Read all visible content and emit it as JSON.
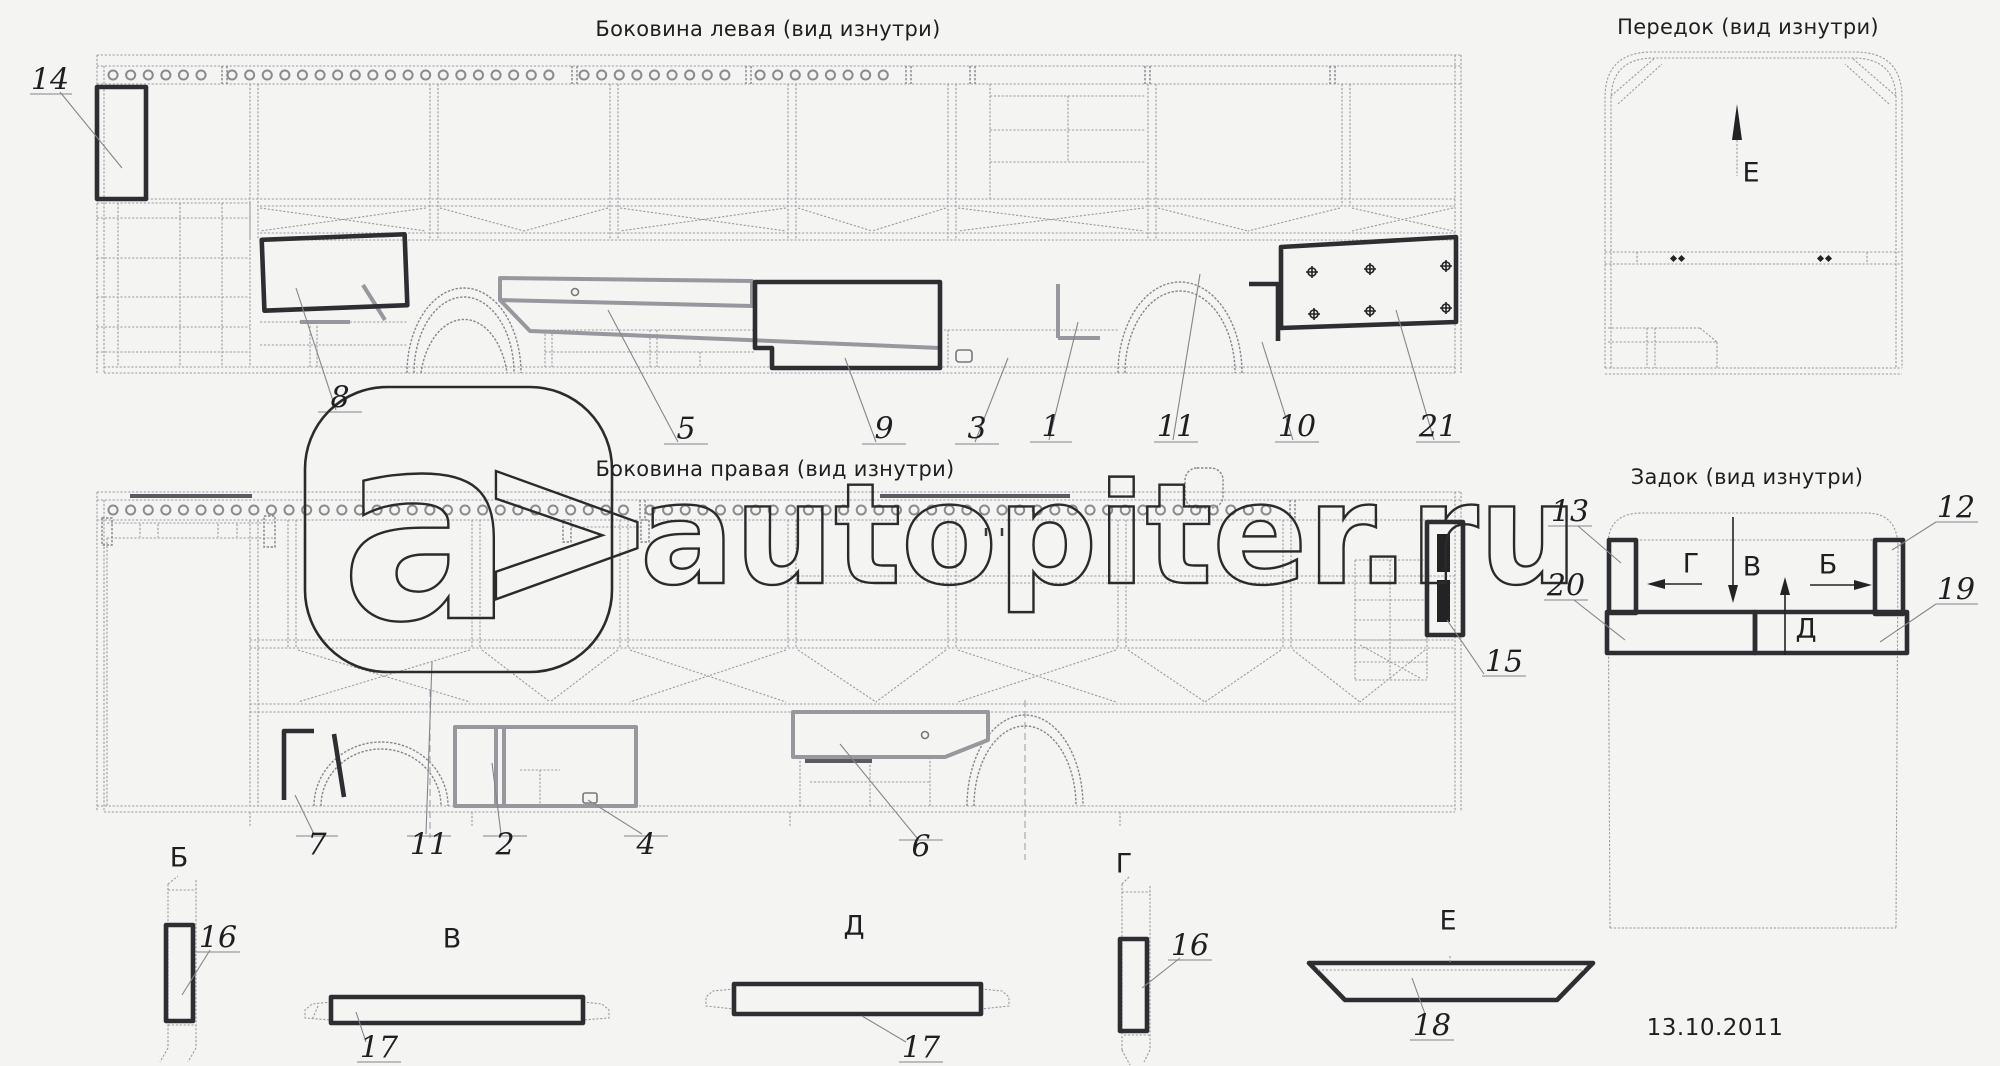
{
  "titles": {
    "left_side": "Боковина левая (вид изнутри)",
    "front": "Передок (вид изнутри)",
    "right_side": "Боковина правая (вид изнутри)",
    "rear": "Задок (вид изнутри)"
  },
  "part_labels": [
    "14",
    "8",
    "5",
    "9",
    "3",
    "1",
    "11",
    "10",
    "21",
    "7",
    "11",
    "2",
    "4",
    "6",
    "15",
    "13",
    "20",
    "12",
    "19",
    "16",
    "17",
    "17",
    "16",
    "18"
  ],
  "section_letters": {
    "bottom": [
      "Б",
      "В",
      "Д",
      "Г",
      "Е"
    ],
    "front_view": "Е",
    "rear_view": [
      "Г",
      "В",
      "Б",
      "Д"
    ]
  },
  "watermark": {
    "letter": "a",
    "chevron": ">",
    "site": "autopiter.ru"
  },
  "date": "13.10.2011"
}
